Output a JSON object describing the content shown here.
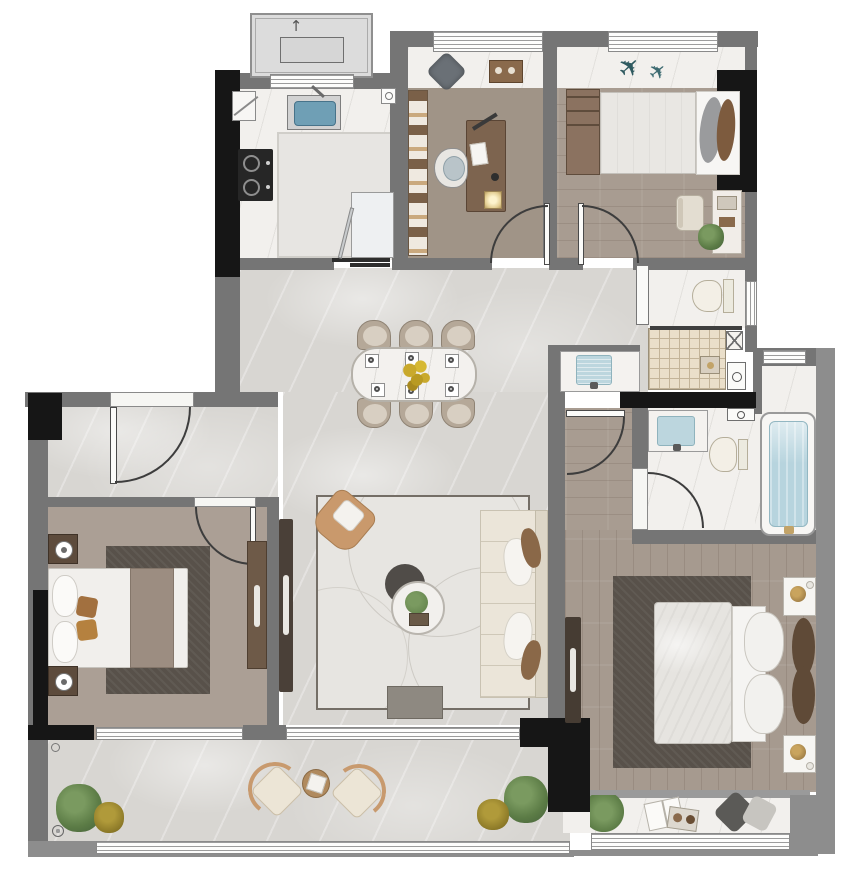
{
  "image_type": "residential-apartment-floor-plan-render",
  "canvas": {
    "width_px": 861,
    "height_px": 872
  },
  "palette": {
    "wall_gray": "#757575",
    "outer_wall_gray": "#8d8d8d",
    "structural_black": "#161616",
    "marble_floor": "#d8d6d2",
    "white_marble": "#f2f0ed",
    "wood_floor": "#a69a8f",
    "shower_tile": "#eadfca",
    "dark_rug": "#58514a",
    "light_rug": "#e7e5e1",
    "water_blue": "#b7d4de",
    "kitchen_sink_blue": "#6f9fb5",
    "sofa_cream": "#ebe5d9",
    "armchair_tan": "#c9996c",
    "furniture_wood": "#7d644f",
    "plant_green": "#5c7c46",
    "plant_yellow": "#8d7a28",
    "flower_yellow": "#c9a92c"
  },
  "rooms": {
    "equipment_platform": {
      "name": "Equipment platform",
      "items": [
        "outdoor AC unit",
        "vent arrow"
      ]
    },
    "kitchen": {
      "name": "Kitchen",
      "items": [
        "sink",
        "2-burner gas cooktop",
        "L-shaped counter",
        "refrigerator",
        "corner cabinet",
        "sliding door tracks",
        "ceiling light"
      ]
    },
    "study": {
      "name": "Study",
      "items": [
        "bookshelf",
        "desk with lamp and papers",
        "office chair",
        "bay-window cushion",
        "tea tray"
      ]
    },
    "bedroom_2": {
      "name": "Bedroom 2",
      "items": [
        "double bed",
        "side dresser",
        "vanity desk",
        "stool",
        "plant",
        "model airplane decor"
      ]
    },
    "guest_bathroom": {
      "name": "Guest bathroom",
      "items": [
        "toilet",
        "tiled shower with glass partition",
        "duct shaft",
        "washer points",
        "sliding door",
        "window"
      ]
    },
    "hallway": {
      "name": "Hallway / Foyer",
      "items": [
        "entry door",
        "wash-basin alcove"
      ]
    },
    "dining_area": {
      "name": "Dining area",
      "items": [
        "dining table",
        "6 chairs",
        "6 place settings",
        "flower centerpiece"
      ]
    },
    "living_room": {
      "name": "Living room",
      "items": [
        "sofa with 4 pillows",
        "armchair",
        "round coffee table",
        "round ottoman",
        "bench",
        "TV console",
        "patterned area rug"
      ]
    },
    "bedroom_1": {
      "name": "Bedroom 1",
      "items": [
        "double bed",
        "2 nightstands with lamps",
        "wardrobe",
        "dark rug"
      ]
    },
    "master_bathroom": {
      "name": "Master bathroom",
      "items": [
        "basin counter",
        "toilet",
        "bathtub",
        "window"
      ]
    },
    "master_bedroom": {
      "name": "Master bedroom",
      "items": [
        "king bed",
        "2 nightstands",
        "TV console",
        "dark rug"
      ]
    },
    "master_balcony": {
      "name": "Master balcony",
      "items": [
        "plant",
        "open book",
        "tray",
        "2 cushions"
      ]
    },
    "main_balcony": {
      "name": "Balcony",
      "items": [
        "2 trees",
        "2 shrubs",
        "2 lounge chairs",
        "round side table",
        "floor drains"
      ]
    }
  }
}
